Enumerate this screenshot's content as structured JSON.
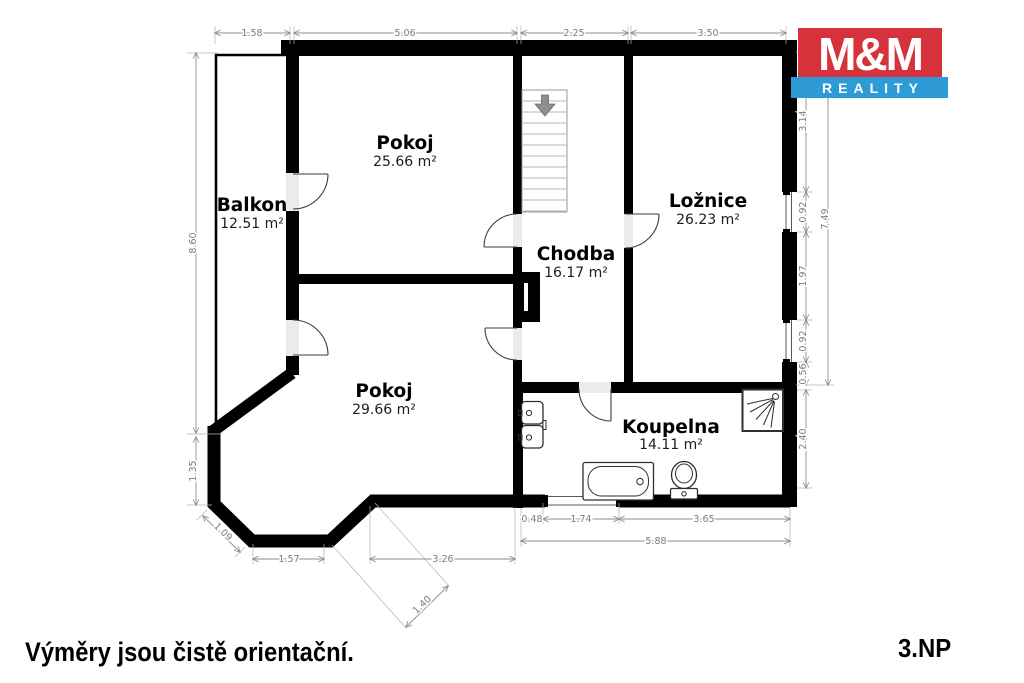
{
  "logo": {
    "top": "M&M",
    "bottom": "REALITY"
  },
  "colors": {
    "logo_red": "#d6323b",
    "logo_blue": "#2f9bd6",
    "wall": "#000000",
    "dim_gray": "#8f8f8f"
  },
  "rooms": {
    "balkon": {
      "name": "Balkon",
      "area": "12.51 m²"
    },
    "pokoj_top": {
      "name": "Pokoj",
      "area": "25.66 m²"
    },
    "chodba": {
      "name": "Chodba",
      "area": "16.17 m²"
    },
    "loznice": {
      "name": "Ložnice",
      "area": "26.23 m²"
    },
    "pokoj_bottom": {
      "name": "Pokoj",
      "area": "29.66 m²"
    },
    "koupelna": {
      "name": "Koupelna",
      "area": "14.11 m²"
    }
  },
  "dimensions": {
    "top": [
      "1.58",
      "5.06",
      "2.25",
      "3.50"
    ],
    "left": [
      "8.60",
      "1.35"
    ],
    "bottom_left_diag": "1.09",
    "bottom_left": "1.57",
    "bottom_mid": "3.26",
    "bay_diag": "1.40",
    "bottom_right": [
      "0.48",
      "1.74",
      "3.65"
    ],
    "bottom_total": "5.88",
    "right": [
      "3.14",
      "0.92",
      "1.97",
      "0.92",
      "0.56"
    ],
    "right_lower": "2.40",
    "right_total": "7.49"
  },
  "footer": {
    "disclaimer": "Výměry jsou čistě orientační.",
    "floor_label": "3.NP"
  }
}
